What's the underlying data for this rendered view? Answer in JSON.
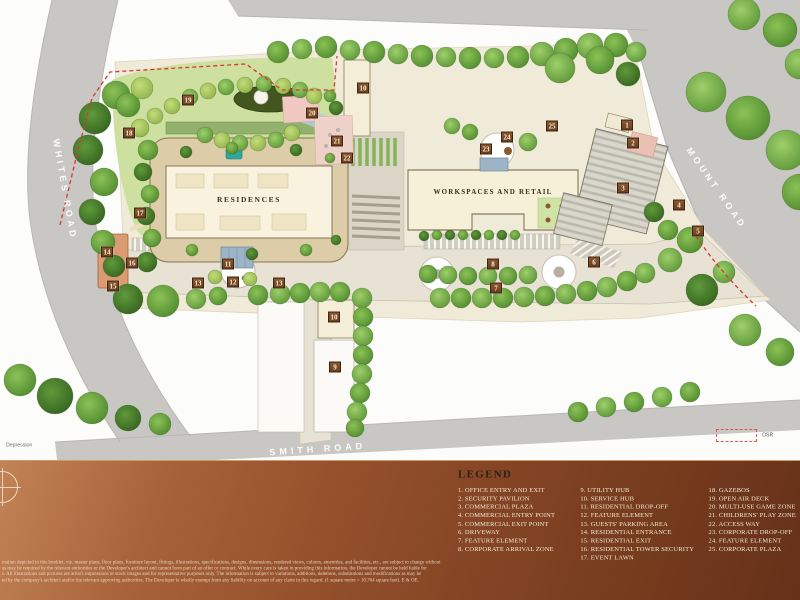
{
  "map": {
    "roads": {
      "whites": "WHITES ROAD",
      "mount": "MOUNT ROAD",
      "smith": "SMITH ROAD"
    },
    "buildings": {
      "residences": "RESIDENCES",
      "workspaces": "WORKSPACES AND RETAIL"
    },
    "annotations": {
      "osr": "OSR",
      "depression": "Depression"
    },
    "markers": [
      {
        "n": "1",
        "x": 627,
        "y": 125
      },
      {
        "n": "2",
        "x": 633,
        "y": 143
      },
      {
        "n": "3",
        "x": 623,
        "y": 188
      },
      {
        "n": "4",
        "x": 679,
        "y": 205
      },
      {
        "n": "5",
        "x": 698,
        "y": 231
      },
      {
        "n": "6",
        "x": 594,
        "y": 262
      },
      {
        "n": "7",
        "x": 496,
        "y": 288
      },
      {
        "n": "8",
        "x": 493,
        "y": 264
      },
      {
        "n": "9",
        "x": 335,
        "y": 367
      },
      {
        "n": "10",
        "x": 363,
        "y": 88
      },
      {
        "n": "10",
        "x": 334,
        "y": 317
      },
      {
        "n": "11",
        "x": 228,
        "y": 264
      },
      {
        "n": "12",
        "x": 233,
        "y": 282
      },
      {
        "n": "13",
        "x": 198,
        "y": 283
      },
      {
        "n": "13",
        "x": 279,
        "y": 283
      },
      {
        "n": "14",
        "x": 107,
        "y": 252
      },
      {
        "n": "15",
        "x": 113,
        "y": 286
      },
      {
        "n": "16",
        "x": 132,
        "y": 263
      },
      {
        "n": "17",
        "x": 140,
        "y": 213
      },
      {
        "n": "18",
        "x": 129,
        "y": 133
      },
      {
        "n": "19",
        "x": 188,
        "y": 100
      },
      {
        "n": "20",
        "x": 312,
        "y": 113
      },
      {
        "n": "21",
        "x": 337,
        "y": 141
      },
      {
        "n": "22",
        "x": 347,
        "y": 158
      },
      {
        "n": "23",
        "x": 486,
        "y": 149
      },
      {
        "n": "24",
        "x": 507,
        "y": 137
      },
      {
        "n": "25",
        "x": 552,
        "y": 126
      }
    ]
  },
  "legend": {
    "title": "LEGEND",
    "columns": [
      [
        "1. OFFICE ENTRY AND EXIT",
        "2. SECURITY PAVILION",
        "3. COMMERCIAL PLAZA",
        "4. COMMERCIAL ENTRY POINT",
        "5. COMMERCIAL EXIT POINT",
        "6. DRIVEWAY",
        "7. FEATURE ELEMENT",
        "8. CORPORATE ARRIVAL ZONE"
      ],
      [
        "9. UTILITY HUB",
        "10. SERVICE HUB",
        "11. RESIDENTIAL DROP-OFF",
        "12. FEATURE ELEMENT",
        "13. GUESTS' PARKING AREA",
        "14. RESIDENTIAL ENTRANCE",
        "15. RESIDENTIAL EXIT",
        "16. RESIDENTIAL TOWER SECURITY",
        "17. EVENT LAWN"
      ],
      [
        "18. GAZEBOS",
        "19. OPEN AIR DECK",
        "20. MULTI-USE GAME ZONE",
        "21. CHILDRENS' PLAY ZONE",
        "22. ACCESS WAY",
        "23. CORPORATE DROP-OFF",
        "24. FEATURE ELEMENT",
        "25. CORPORATE PLAZA"
      ]
    ]
  },
  "disclaimer": {
    "lines": [
      "mation depicted in this booklet, viz. master plans, floor plans, furniture layout, fittings, illustrations, specifications, designs, dimensions, rendered views, colours, amenities, and facilities, etc., are subject to change without",
      "as may be required by the relevant authorities or the Developer's architect and cannot form part of an offer or contract. While every care is taken in providing this information, the Developer cannot be held liable for",
      "s. All illustrations and pictures are artist's impressions or stock images and for representative purposes only. The information is subject to variations, additions, deletions, substitutions and modifications as may be",
      "ed by the company's architect and/or the relevant approving authorities. The Developer is wholly exempt from any liability on account of any claim in this regard. (1 square metre = 10.764 square feet). E & OE."
    ]
  },
  "colors": {
    "band_copper": "#8c4a26",
    "marker_brown": "#7d4e2a",
    "boundary_red": "#d63a2c",
    "road_gray": "#c8c7c3",
    "site_cream": "#f0ead9",
    "tree_green": "#6faf46",
    "lawn_green": "#c3d795"
  }
}
